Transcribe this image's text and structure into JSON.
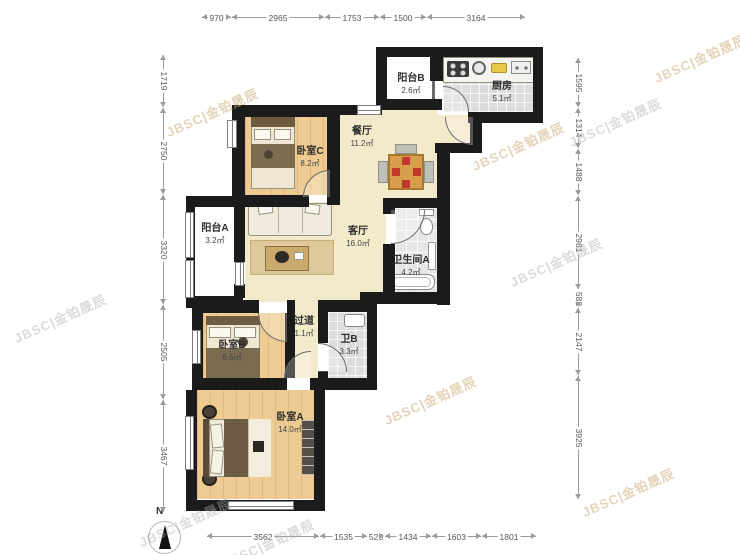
{
  "compass": {
    "label": "N"
  },
  "watermark": {
    "text": "JBSC|金铂晟辰"
  },
  "rooms": {
    "balcony_b": {
      "name": "阳台B",
      "area": "2.6㎡"
    },
    "kitchen": {
      "name": "厨房",
      "area": "5.1㎡"
    },
    "dining": {
      "name": "餐厅",
      "area": "11.2㎡"
    },
    "bedroom_c": {
      "name": "卧室C",
      "area": "8.2㎡"
    },
    "balcony_a": {
      "name": "阳台A",
      "area": "3.2㎡"
    },
    "living": {
      "name": "客厅",
      "area": "16.0㎡"
    },
    "bathroom_a": {
      "name": "卫生间A",
      "area": "4.2㎡"
    },
    "hallway": {
      "name": "过道",
      "area": "1.1㎡"
    },
    "bedroom_b": {
      "name": "卧室B",
      "area": "6.5㎡"
    },
    "bathroom_b": {
      "name": "卫B",
      "area": "3.3㎡"
    },
    "bedroom_a": {
      "name": "卧室A",
      "area": "14.0㎡"
    }
  },
  "dimensions": {
    "top": [
      "970",
      "2965",
      "1753",
      "1500",
      "3164"
    ],
    "left": [
      "1719",
      "2750",
      "3320",
      "2505",
      "3467"
    ],
    "right": [
      "1595",
      "1314",
      "1488",
      "2981",
      "582",
      "2147",
      "3925"
    ],
    "bottom": [
      "3562",
      "1535",
      "525",
      "1434",
      "1603",
      "1801"
    ]
  },
  "colors": {
    "wall": "#1b1b1b",
    "floor_cream": "#f3e9cb",
    "floor_wood": "#edcb92",
    "floor_tile": "#dcdcdc",
    "cushion_red": "#c0392b",
    "watermark_tan": "#cdaf7d"
  }
}
